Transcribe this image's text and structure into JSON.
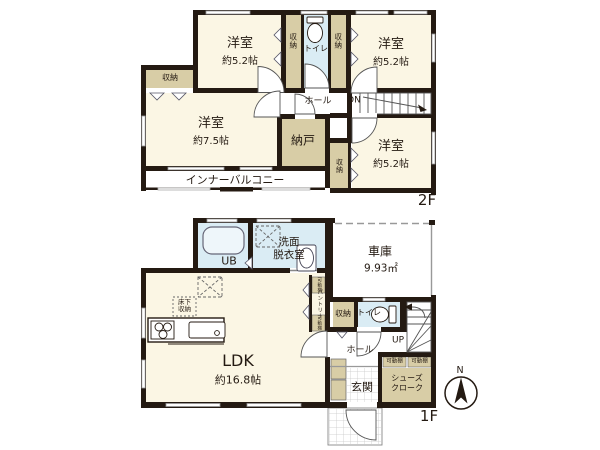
{
  "colors": {
    "room_cream": "#fbf6e4",
    "closet_tan": "#d8cda6",
    "wet_blue": "#daecf4",
    "wall_dark": "#241a12"
  },
  "floor2": {
    "label": "2F",
    "bedroom_nw": {
      "name": "洋室",
      "size": "約5.2帖"
    },
    "bedroom_ne": {
      "name": "洋室",
      "size": "約5.2帖"
    },
    "bedroom_w": {
      "name": "洋室",
      "size": "約7.5帖"
    },
    "bedroom_se": {
      "name": "洋室",
      "size": "約5.2帖"
    },
    "closet_nw": "収納",
    "closet_ne": "収納",
    "closet_w": "収納",
    "closet_se": "収納",
    "toilet": "トイレ",
    "hall": "ホール",
    "stairs_down": "DN",
    "storeroom": "納戸",
    "inner_balcony": "インナーバルコニー"
  },
  "floor1": {
    "label": "1F",
    "unit_bath": "UB",
    "washroom": "洗面\n脱衣室",
    "garage": {
      "name": "車庫",
      "size": "9.93㎡"
    },
    "ldk": {
      "name": "LDK",
      "size": "約16.8帖"
    },
    "underfloor_storage": "床下\n収納",
    "pantry": "パントリー",
    "movable_shelf": "可動棚",
    "closet": "収納",
    "toilet": "トイレ",
    "stairs_up": "UP",
    "hall": "ホール",
    "entrance": "玄関",
    "shoe_closet": "シューズ\nクローク"
  },
  "compass": {
    "north": "N"
  }
}
